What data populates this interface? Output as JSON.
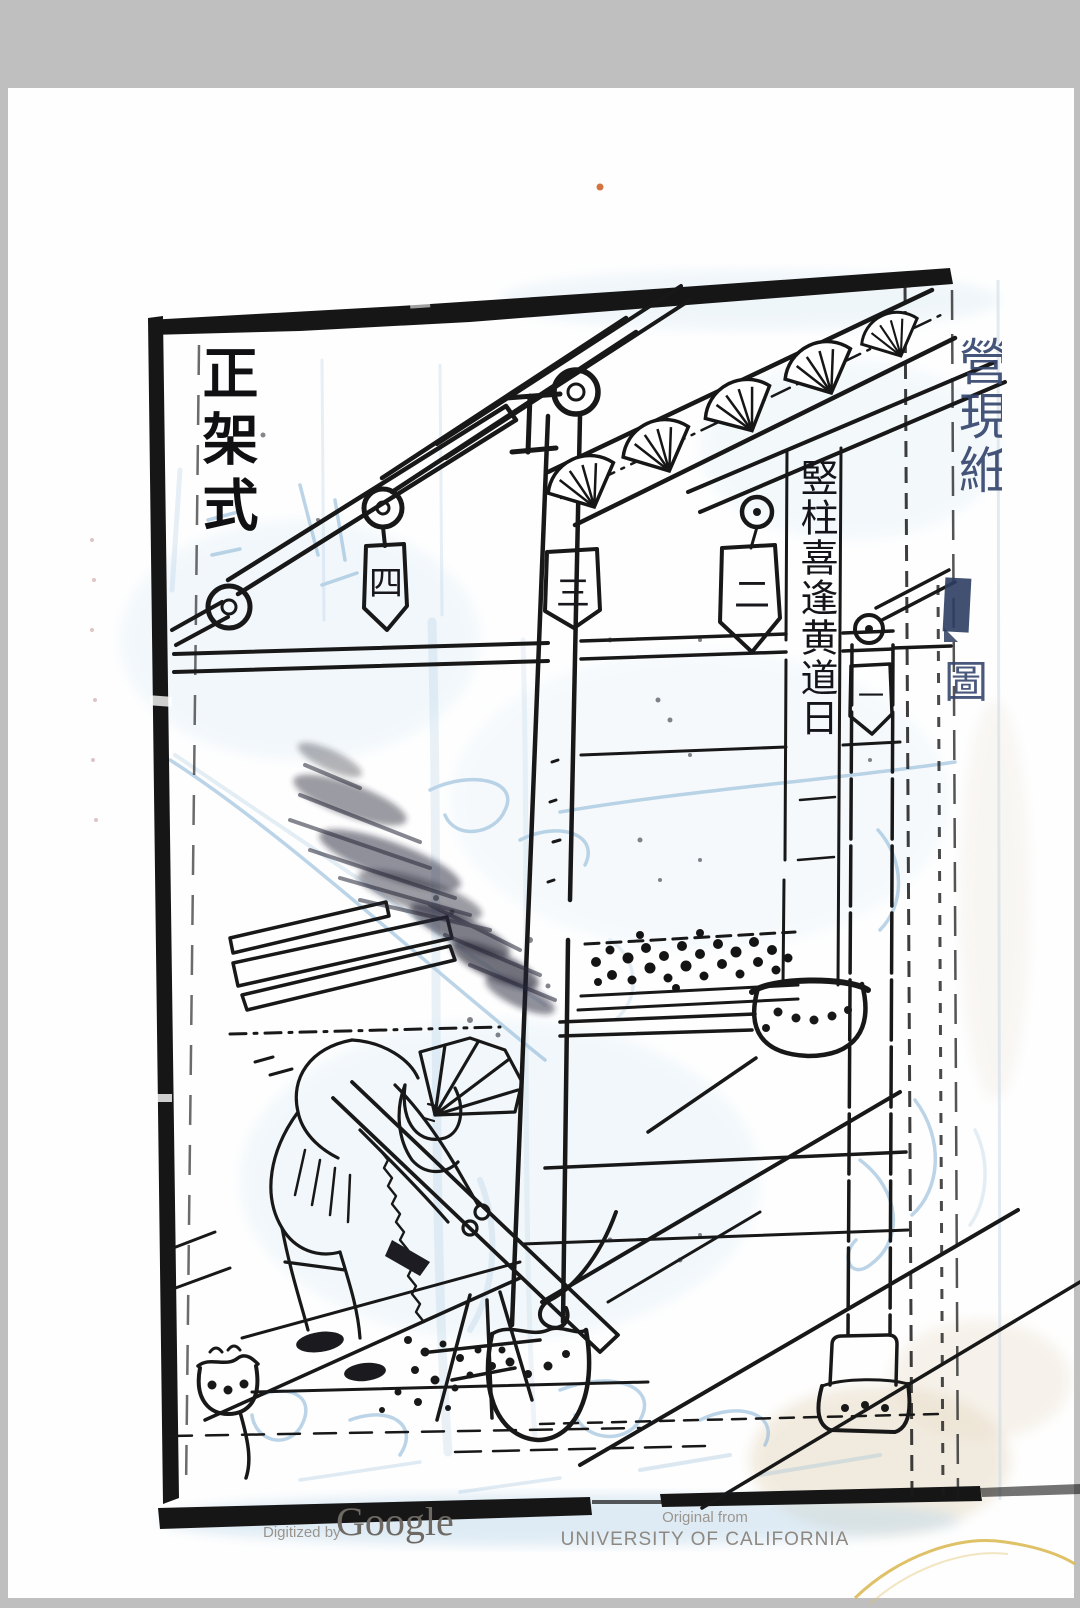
{
  "page": {
    "background_color": "#bfbfbf",
    "paper_color": "#fefefe"
  },
  "woodcut": {
    "title": "正架式",
    "pillar_caption": "竪柱喜逢黄道日",
    "tag_labels": [
      "四",
      "三",
      "二",
      "一"
    ],
    "edge_title": "營現絍",
    "edge_boxed_char": "圖",
    "ink_color": "#1a1a1a",
    "bleedthrough_color": "#8fb8d8"
  },
  "footer": {
    "digitized_by": "Digitized by",
    "google_wordmark": "Google",
    "original_from": "Original from",
    "institution": "UNIVERSITY OF CALIFORNIA"
  }
}
